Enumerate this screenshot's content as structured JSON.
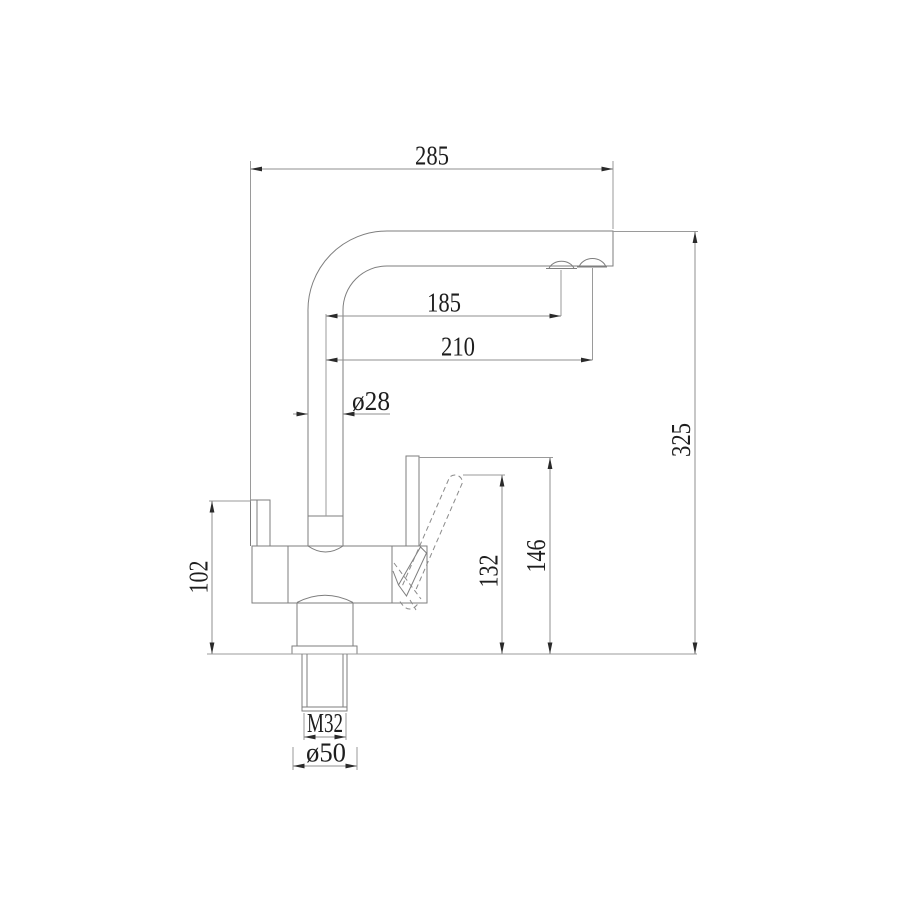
{
  "drawing": {
    "dimensions": {
      "overall_reach": "285",
      "reach_to_aerator": "185",
      "reach_to_spout_end": "210",
      "spout_tube_diameter": "ø28",
      "overall_height": "325",
      "lever_height": "146",
      "lever_tilted_height": "132",
      "body_side_height": "102",
      "thread_size": "M32",
      "base_diameter": "ø50"
    },
    "colors": {
      "background": "#ffffff",
      "outline": "#7e7e7e",
      "dimension_lines": "#8f8f8f",
      "arrowheads": "#2a2a2a",
      "label_text": "#1e1e1e"
    }
  }
}
